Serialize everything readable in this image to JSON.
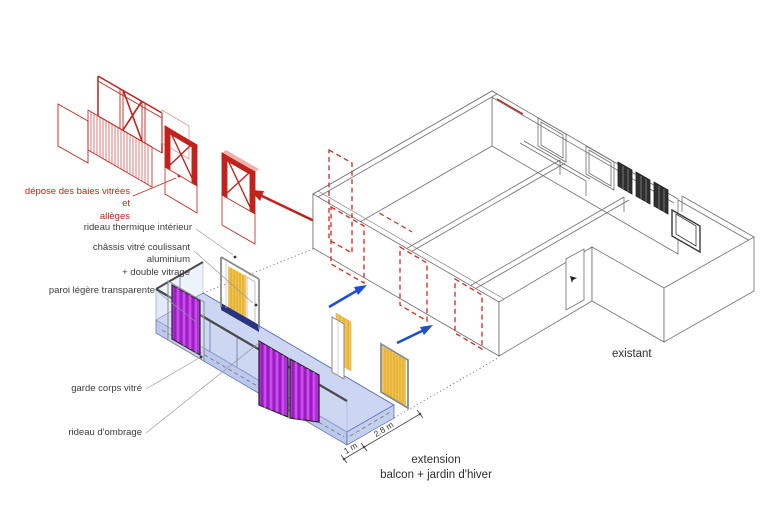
{
  "diagram": {
    "type": "axonometric architectural diagram - balcony / winter garden extension",
    "labels": {
      "demolition": "dépose des baies vitrées et\nallèges",
      "thermal_curtain": "rideau thermique intérieur",
      "sliding_frame": "châssis vitré coulissant\naluminium\n+ double vitrage",
      "light_wall": "paroi légère transparente",
      "guardrail": "garde corps vitré",
      "shade_curtain": "rideau d'ombrage",
      "existing": "existant",
      "extension": "extension\nbalcon + jardin d'hiver",
      "dim_1": "1 m",
      "dim_2": "2.8 m"
    },
    "colors": {
      "demolition_red": "#c0231d",
      "arrow_blue": "#1d4ed8",
      "deck_fill": "#ccd6f2",
      "deck_edge": "#5468b4",
      "curtain_purple": "#b02fd6",
      "curtain_yellow": "#f2c44e",
      "sill_blue": "#28347f",
      "line_gray": "#6f6f6f",
      "background": "#ffffff"
    }
  }
}
